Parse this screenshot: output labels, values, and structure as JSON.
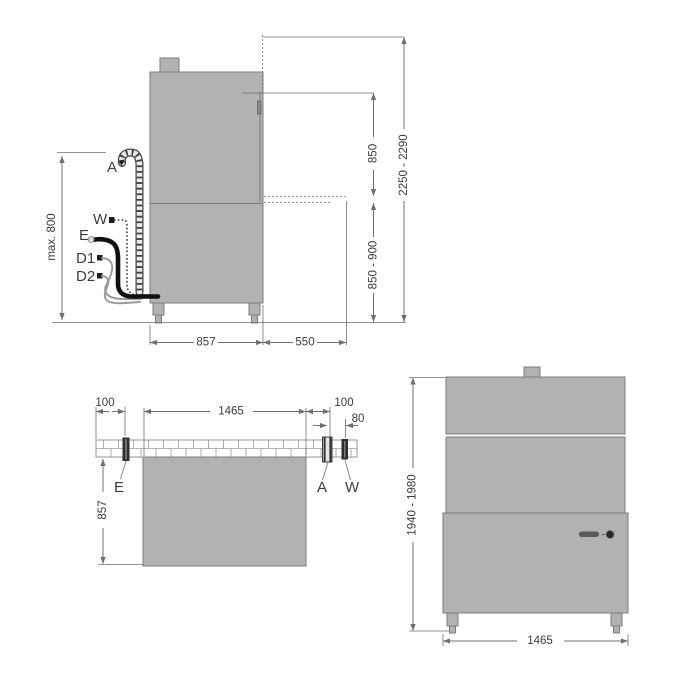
{
  "colors": {
    "machine_fill": "#b2b2b2",
    "machine_border": "#7c7c7c",
    "line": "#6f6f6f",
    "text": "#3c3c3c",
    "dark": "#1e1e1e",
    "hose_gray": "#9a9a9a",
    "background": "#ffffff"
  },
  "side_view": {
    "connection_labels": {
      "drain": "A",
      "water": "W",
      "electric": "E",
      "dosing1": "D1",
      "dosing2": "D2"
    },
    "dims": {
      "hose_height": "max. 800",
      "body_depth": "857",
      "table_depth": "550",
      "hood_opening": "850",
      "table_height": "850 - 900",
      "total_height": "2250 - 2290"
    }
  },
  "top_view": {
    "connection_labels": {
      "electric": "E",
      "drain": "A",
      "water": "W"
    },
    "dims": {
      "electric_offset": "100",
      "body_width": "1465",
      "drain_offset": "100",
      "water_offset": "80",
      "body_depth": "857"
    }
  },
  "front_view": {
    "dims": {
      "height_range": "1940 - 1980",
      "body_width": "1465"
    }
  }
}
